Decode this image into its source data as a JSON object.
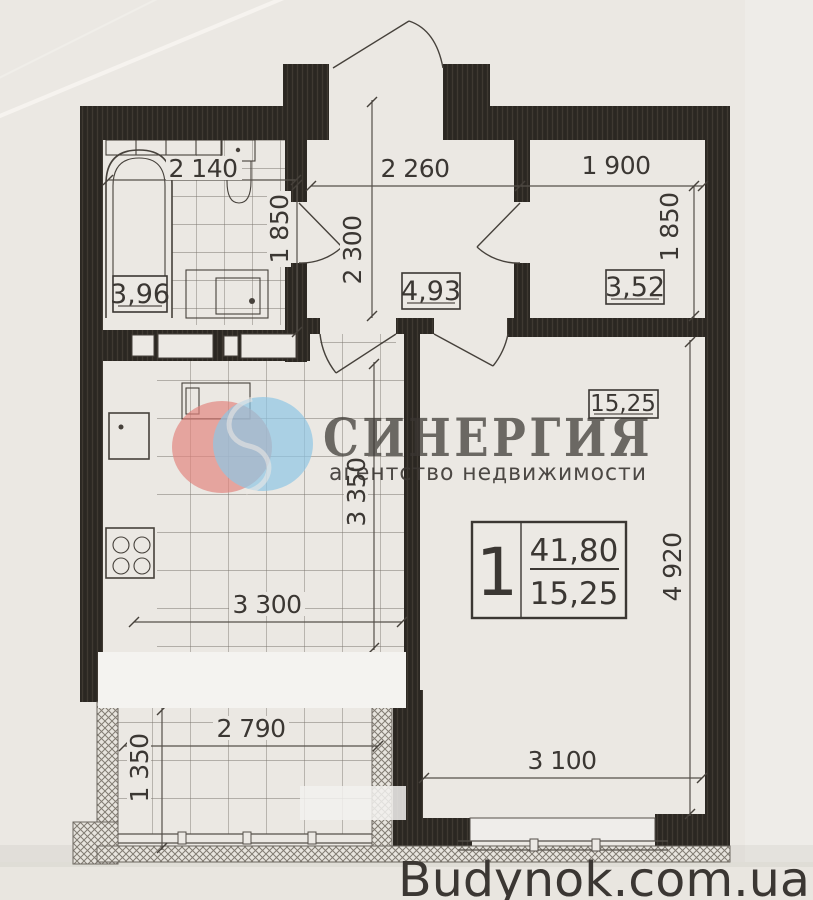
{
  "page": {
    "paper_color": "#ebe8e3",
    "ink_color": "#46413b",
    "wall_color": "#2b2722"
  },
  "watermark": {
    "brand": "СИНЕРГИЯ",
    "tagline": "агентство недвижимости",
    "brand_color": "#db7b7b",
    "tagline_color": "#8fc0dc",
    "logo_left_circle_color": "#e2837d",
    "logo_right_circle_color": "#8ec6e4"
  },
  "site_credit": {
    "text": "Budynok.com.ua",
    "color": "#2b3cae"
  },
  "apartment_stamp": {
    "rooms_count": "1",
    "total_area": "41,80",
    "living_area": "15,25"
  },
  "rooms": {
    "bathroom": {
      "area": "3,96",
      "width": "2 140",
      "depth": "1 850"
    },
    "hall": {
      "area": "4,93",
      "width": "2 260",
      "depth": "2 300"
    },
    "storage": {
      "area": "3,52",
      "width": "1 900",
      "depth": "1 850"
    },
    "kitchen": {
      "width": "3 300",
      "depth": "3 350"
    },
    "living_room": {
      "area": "15,25",
      "width": "3 100",
      "depth": "4 920"
    },
    "balcony": {
      "width": "2 790",
      "depth": "1 350"
    }
  }
}
